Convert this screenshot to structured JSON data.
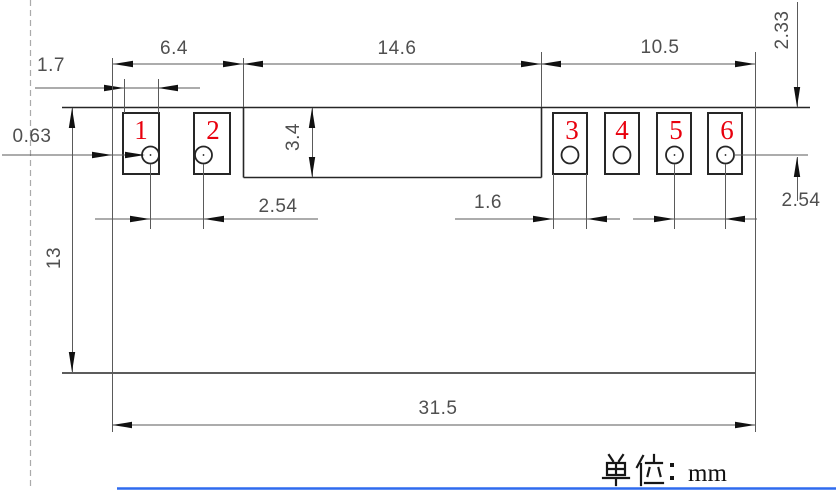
{
  "unit_note": "单位：mm",
  "unit_suffix": "mm",
  "pins": [
    "1",
    "2",
    "3",
    "4",
    "5",
    "6"
  ],
  "dimensions": {
    "left_group_width": "6.4",
    "center_section_width": "14.6",
    "right_group_width": "10.5",
    "left_pad_width": "1.7",
    "hole_diameter": "0.63",
    "pad_height": "3.4",
    "left_hole_pitch": "2.54",
    "right_pad_width": "1.6",
    "right_hole_pitch": "2.54",
    "hole_row_offset": "2.33",
    "body_height": "13",
    "overall_width": "31.5"
  },
  "colors": {
    "pin_number": "#e8000d",
    "dimension_line": "#5a5a5a",
    "geometry_line": "#262626",
    "bottom_rule": "#2f6bef"
  }
}
